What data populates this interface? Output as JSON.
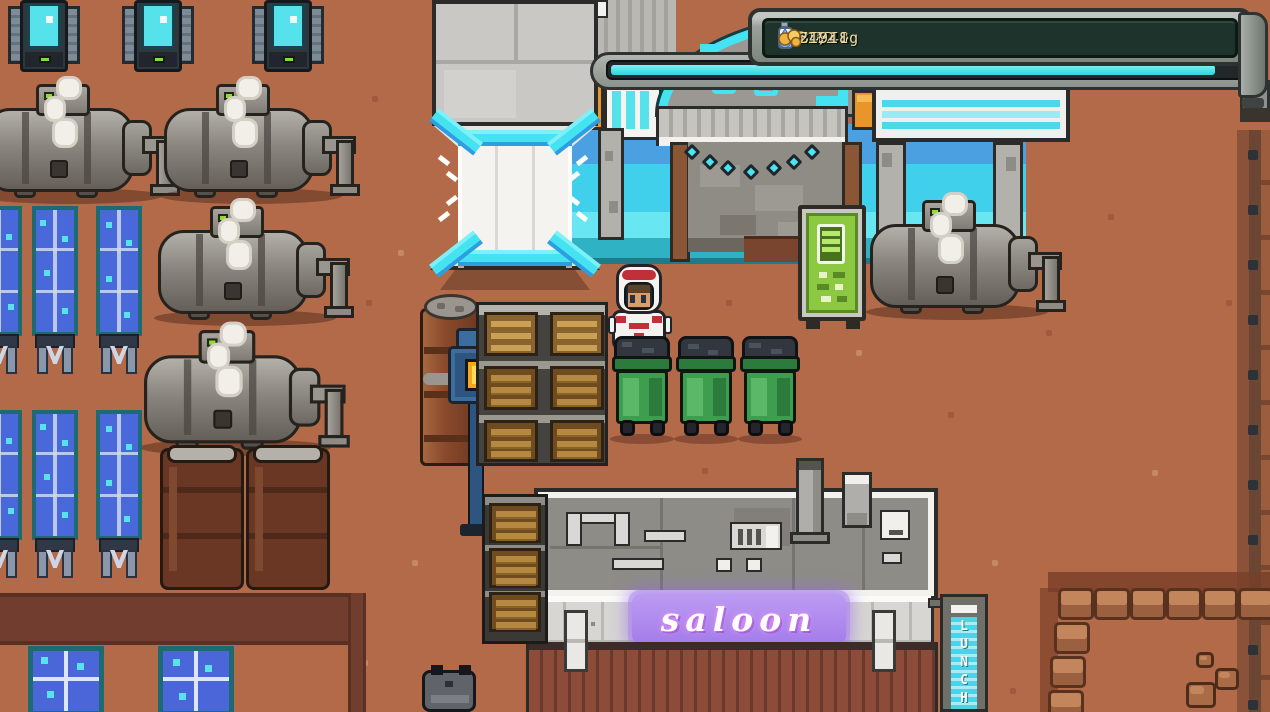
{
  "hud": {
    "sol_label": "Sol",
    "sol_value": "32",
    "colonists_value": "16",
    "power_value": "52/62",
    "oxygen_value": "36/40",
    "oxygen_tank_label": "O2",
    "water_value": "24/48",
    "money_value": "1911g",
    "progress_percent": 95,
    "icons": [
      "colonists-icon",
      "lightning-icon",
      "oxygen-tank-icon",
      "water-drop-icon",
      "coins-icon"
    ],
    "colors": {
      "panel_bg": "#1d332b",
      "text": "#eed9a2",
      "bar_fill": "#3fdde4",
      "frame": "#9aa09c"
    }
  },
  "scene": {
    "saloon_sign_text": "saloon",
    "saloon_neon_color": "#b18cf0",
    "lunch_sign_letters": [
      "L",
      "U",
      "N",
      "C",
      "H"
    ],
    "fuel_sign_icon": "battery-icon",
    "accent_cyan": "#4ae4f2",
    "terrain_color": "#b26a48"
  }
}
